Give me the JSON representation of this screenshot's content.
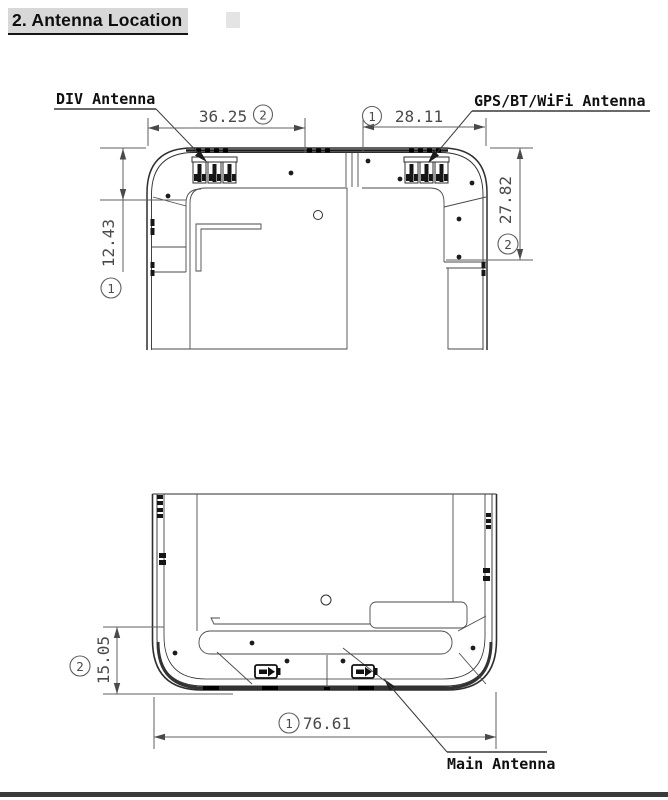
{
  "document": {
    "section_title": "2. Antenna Location"
  },
  "colors": {
    "title_highlight": "#d8d8d8",
    "drawing_line": "#2e2e2e",
    "dimension_line": "#5f5f5f",
    "dimension_text": "#4a4a4a",
    "label_text": "#101010",
    "footer_bar": "#3a3a3a"
  },
  "top_view": {
    "labels": {
      "div_antenna": "DIV Antenna",
      "gps_bt_wifi_antenna": "GPS/BT/WiFi Antenna"
    },
    "dimensions": {
      "width_left": {
        "value": "36.25",
        "ref": "2"
      },
      "width_right": {
        "value": "28.11",
        "ref": "1"
      },
      "height_left": {
        "value": "12.43",
        "ref": "1"
      },
      "height_right": {
        "value": "27.82",
        "ref": "2"
      }
    }
  },
  "bottom_view": {
    "labels": {
      "main_antenna": "Main Antenna"
    },
    "dimensions": {
      "height_left": {
        "value": "15.05",
        "ref": "2"
      },
      "width_bottom": {
        "value": "76.61",
        "ref": "1"
      }
    }
  }
}
